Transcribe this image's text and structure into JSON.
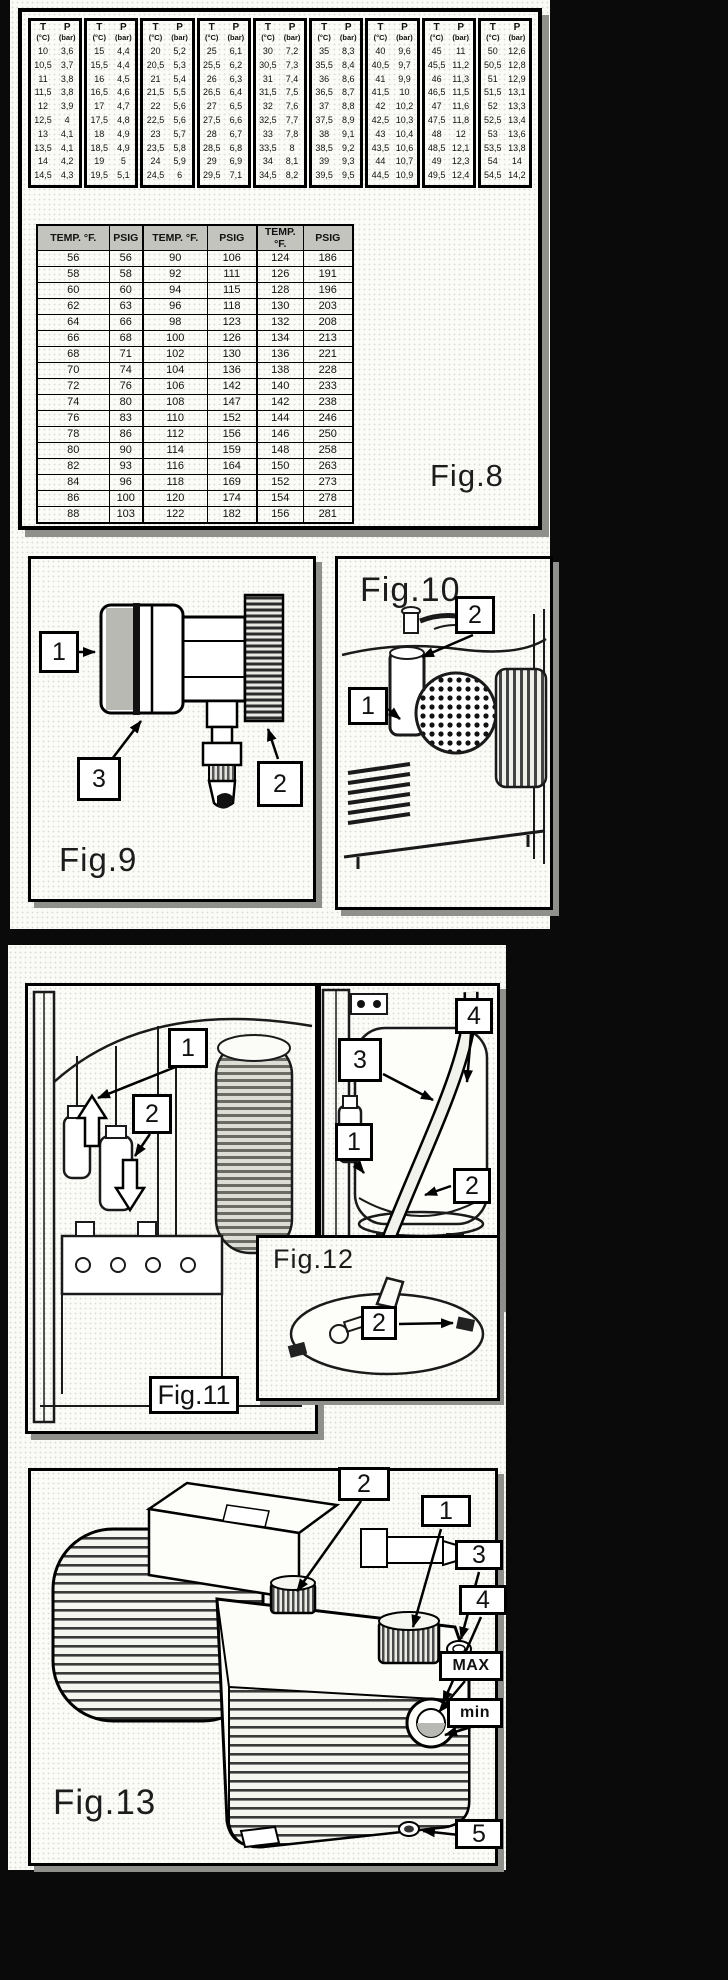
{
  "page1": {
    "fig8": {
      "label": "Fig.8",
      "tp_table": {
        "t_header": "T",
        "t_unit": "(°C)",
        "p_header": "P",
        "p_unit": "(bar)",
        "columns": [
          {
            "t": [
              "10",
              "10,5",
              "11",
              "11,5",
              "12",
              "12,5",
              "13",
              "13,5",
              "14",
              "14,5"
            ],
            "p": [
              "3,6",
              "3,7",
              "3,8",
              "3,8",
              "3,9",
              "4",
              "4,1",
              "4,1",
              "4,2",
              "4,3"
            ]
          },
          {
            "t": [
              "15",
              "15,5",
              "16",
              "16,5",
              "17",
              "17,5",
              "18",
              "18,5",
              "19",
              "19,5"
            ],
            "p": [
              "4,4",
              "4,4",
              "4,5",
              "4,6",
              "4,7",
              "4,8",
              "4,9",
              "4,9",
              "5",
              "5,1"
            ]
          },
          {
            "t": [
              "20",
              "20,5",
              "21",
              "21,5",
              "22",
              "22,5",
              "23",
              "23,5",
              "24",
              "24,5"
            ],
            "p": [
              "5,2",
              "5,3",
              "5,4",
              "5,5",
              "5,6",
              "5,6",
              "5,7",
              "5,8",
              "5,9",
              "6"
            ]
          },
          {
            "t": [
              "25",
              "25,5",
              "26",
              "26,5",
              "27",
              "27,5",
              "28",
              "28,5",
              "29",
              "29,5"
            ],
            "p": [
              "6,1",
              "6,2",
              "6,3",
              "6,4",
              "6,5",
              "6,6",
              "6,7",
              "6,8",
              "6,9",
              "7,1"
            ]
          },
          {
            "t": [
              "30",
              "30,5",
              "31",
              "31,5",
              "32",
              "32,5",
              "33",
              "33,5",
              "34",
              "34,5"
            ],
            "p": [
              "7,2",
              "7,3",
              "7,4",
              "7,5",
              "7,6",
              "7,7",
              "7,8",
              "8",
              "8,1",
              "8,2"
            ]
          },
          {
            "t": [
              "35",
              "35,5",
              "36",
              "36,5",
              "37",
              "37,5",
              "38",
              "38,5",
              "39",
              "39,5"
            ],
            "p": [
              "8,3",
              "8,4",
              "8,6",
              "8,7",
              "8,8",
              "8,9",
              "9,1",
              "9,2",
              "9,3",
              "9,5"
            ]
          },
          {
            "t": [
              "40",
              "40,5",
              "41",
              "41,5",
              "42",
              "42,5",
              "43",
              "43,5",
              "44",
              "44,5"
            ],
            "p": [
              "9,6",
              "9,7",
              "9,9",
              "10",
              "10,2",
              "10,3",
              "10,4",
              "10,6",
              "10,7",
              "10,9"
            ]
          },
          {
            "t": [
              "45",
              "45,5",
              "46",
              "46,5",
              "47",
              "47,5",
              "48",
              "48,5",
              "49",
              "49,5"
            ],
            "p": [
              "11",
              "11,2",
              "11,3",
              "11,5",
              "11,6",
              "11,8",
              "12",
              "12,1",
              "12,3",
              "12,4"
            ]
          },
          {
            "t": [
              "50",
              "50,5",
              "51",
              "51,5",
              "52",
              "52,5",
              "53",
              "53,5",
              "54",
              "54,5"
            ],
            "p": [
              "12,6",
              "12,8",
              "12,9",
              "13,1",
              "13,3",
              "13,4",
              "13,6",
              "13,8",
              "14",
              "14,2"
            ]
          }
        ]
      },
      "psig_table": {
        "headers": [
          "TEMP. °F.",
          "PSIG",
          "TEMP. °F.",
          "PSIG",
          "TEMP. °F.",
          "PSIG"
        ],
        "rows": [
          [
            "56",
            "56",
            "90",
            "106",
            "124",
            "186"
          ],
          [
            "58",
            "58",
            "92",
            "111",
            "126",
            "191"
          ],
          [
            "60",
            "60",
            "94",
            "115",
            "128",
            "196"
          ],
          [
            "62",
            "63",
            "96",
            "118",
            "130",
            "203"
          ],
          [
            "64",
            "66",
            "98",
            "123",
            "132",
            "208"
          ],
          [
            "66",
            "68",
            "100",
            "126",
            "134",
            "213"
          ],
          [
            "68",
            "71",
            "102",
            "130",
            "136",
            "221"
          ],
          [
            "70",
            "74",
            "104",
            "136",
            "138",
            "228"
          ],
          [
            "72",
            "76",
            "106",
            "142",
            "140",
            "233"
          ],
          [
            "74",
            "80",
            "108",
            "147",
            "142",
            "238"
          ],
          [
            "76",
            "83",
            "110",
            "152",
            "144",
            "246"
          ],
          [
            "78",
            "86",
            "112",
            "156",
            "146",
            "250"
          ],
          [
            "80",
            "90",
            "114",
            "159",
            "148",
            "258"
          ],
          [
            "82",
            "93",
            "116",
            "164",
            "150",
            "263"
          ],
          [
            "84",
            "96",
            "118",
            "169",
            "152",
            "273"
          ],
          [
            "86",
            "100",
            "120",
            "174",
            "154",
            "278"
          ],
          [
            "88",
            "103",
            "122",
            "182",
            "156",
            "281"
          ]
        ]
      }
    },
    "fig9": {
      "label": "Fig.9",
      "callouts": [
        "1",
        "3",
        "2"
      ]
    },
    "fig10": {
      "label": "Fig.10",
      "callouts": [
        "2",
        "1"
      ]
    }
  },
  "page2": {
    "fig11": {
      "label": "Fig.11",
      "callouts": [
        "1",
        "2"
      ]
    },
    "fig12": {
      "label": "Fig.12",
      "panel_callouts": [
        "4",
        "3",
        "1",
        "2"
      ],
      "inset_callout": "2"
    },
    "fig13": {
      "label": "Fig.13",
      "callouts": [
        "2",
        "1",
        "3",
        "4",
        "MAX",
        "min",
        "5"
      ]
    }
  },
  "colors": {
    "paper": "#fafaf6",
    "ink": "#111111",
    "shadow": "#8f8f8b",
    "header_gray": "#c4c4be"
  }
}
